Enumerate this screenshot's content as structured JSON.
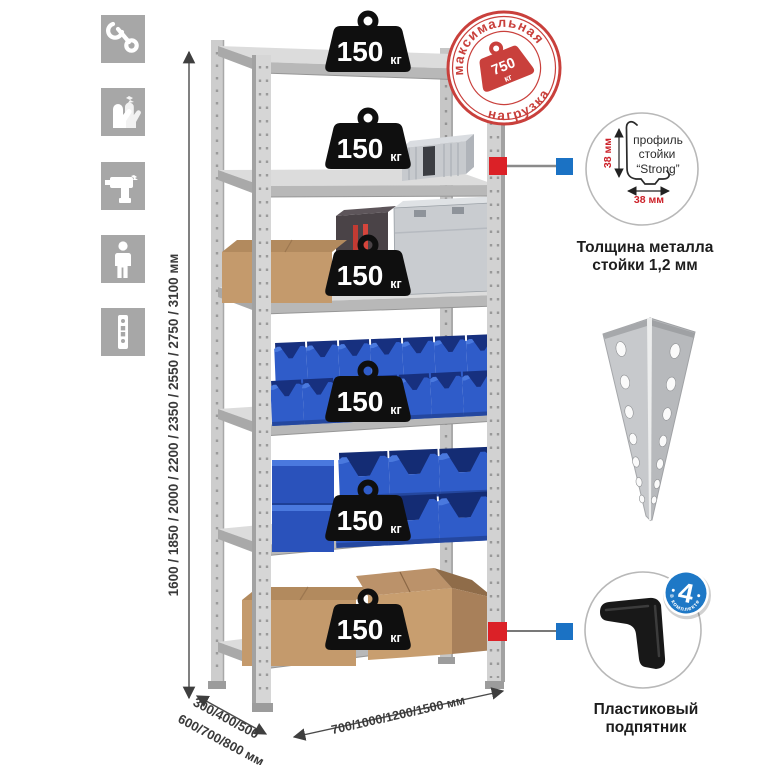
{
  "colors": {
    "accent_red": "#db2127",
    "accent_blue": "#1b72c4",
    "stamp_red": "#c9403c",
    "bin_blue": "#2f5cc9",
    "icon_gray": "#a7a7a7",
    "metal_light": "#d8d8d8",
    "cardboard": "#c49a6c",
    "text_dark": "#3a3a3a"
  },
  "sidebar": {
    "icons": [
      {
        "name": "wrench"
      },
      {
        "name": "gloves"
      },
      {
        "name": "drill"
      },
      {
        "name": "person"
      },
      {
        "name": "perforated-post"
      }
    ]
  },
  "rack": {
    "shelf_count": 6,
    "weights": [
      {
        "value": "150",
        "unit": "кг"
      },
      {
        "value": "150",
        "unit": "кг"
      },
      {
        "value": "150",
        "unit": "кг"
      },
      {
        "value": "150",
        "unit": "кг"
      },
      {
        "value": "150",
        "unit": "кг"
      },
      {
        "value": "150",
        "unit": "кг"
      }
    ]
  },
  "stamp": {
    "arc_top": "максимальная",
    "arc_bottom": "нагрузка",
    "weight_value": "750",
    "weight_unit": "кг"
  },
  "dimensions": {
    "height": "1600 / 1850 / 2000 / 2200 / 2350 / 2550 / 2750 / 3100 мм",
    "depth_line1": "300/400/500",
    "depth_line2": "600/700/800 мм",
    "width": "700/1000/1200/1500 мм"
  },
  "profile_detail": {
    "label_line1": "профиль",
    "label_line2": "стойки",
    "label_line3": "“Strong”",
    "dim_height": "38 мм",
    "dim_width": "38 мм",
    "caption_line1": "Толщина металла",
    "caption_line2": "стойки 1,2 мм"
  },
  "foot_detail": {
    "badge_value": "4",
    "badge_arc": "в комплекте",
    "caption_line1": "Пластиковый",
    "caption_line2": "подпятник"
  }
}
